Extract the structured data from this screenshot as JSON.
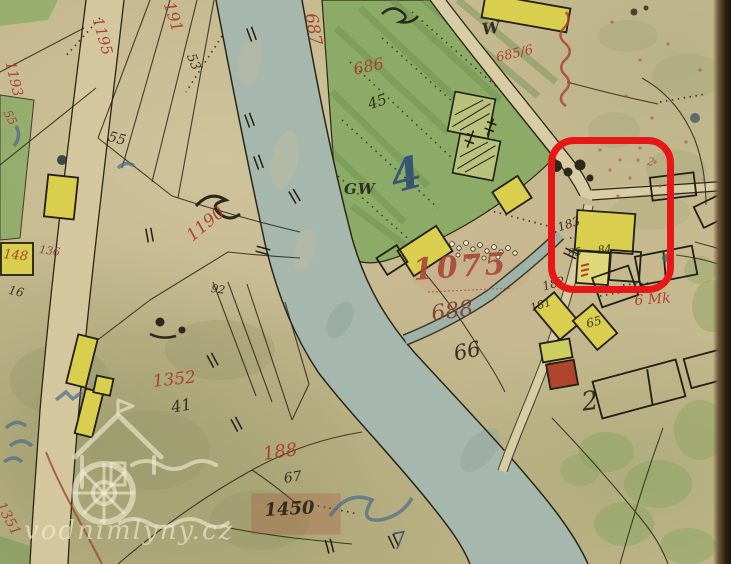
{
  "map": {
    "kind": "historic cadastral map scan",
    "colors": {
      "paper": "#c6b98f",
      "river": "#a6b7ad",
      "meadow_green": "#8cab67",
      "building_yellow": "#d9ce4e",
      "masonry_red": "#b0452e",
      "red_ink": "#a93b2c",
      "blue_ink": "#2f4f73",
      "black_ink": "#2a2619",
      "highlight_red": "#e81717"
    },
    "labels": {
      "p191": "191",
      "p1195": "1195",
      "p1193": "1193",
      "p55r": "55",
      "p53": "53",
      "p55": "55",
      "p1190": "1190",
      "p687": "687",
      "p686": "686",
      "p45": "45",
      "p4": "4",
      "gw": "GW",
      "w": "W",
      "p685_6": "685/6",
      "p148": "148",
      "p136": "136",
      "p16": "16",
      "p92": "92",
      "p1075": "1075",
      "p688": "688",
      "p66": "66",
      "p6mk": "6 Mk",
      "p183": "183",
      "p85": "85",
      "p84": "84",
      "p182": "182",
      "p181": "181",
      "p65": "65",
      "p2": "2",
      "p2r": "2",
      "p1352": "1352",
      "p41": "41",
      "p188": "188",
      "p67": "67",
      "p1450": "1450",
      "p1351": "1351",
      "p7": "7"
    }
  },
  "watermark": {
    "text": "vodnimlyny.cz"
  },
  "annotation": {
    "shape": "rounded-rectangle",
    "color": "#e81717"
  }
}
